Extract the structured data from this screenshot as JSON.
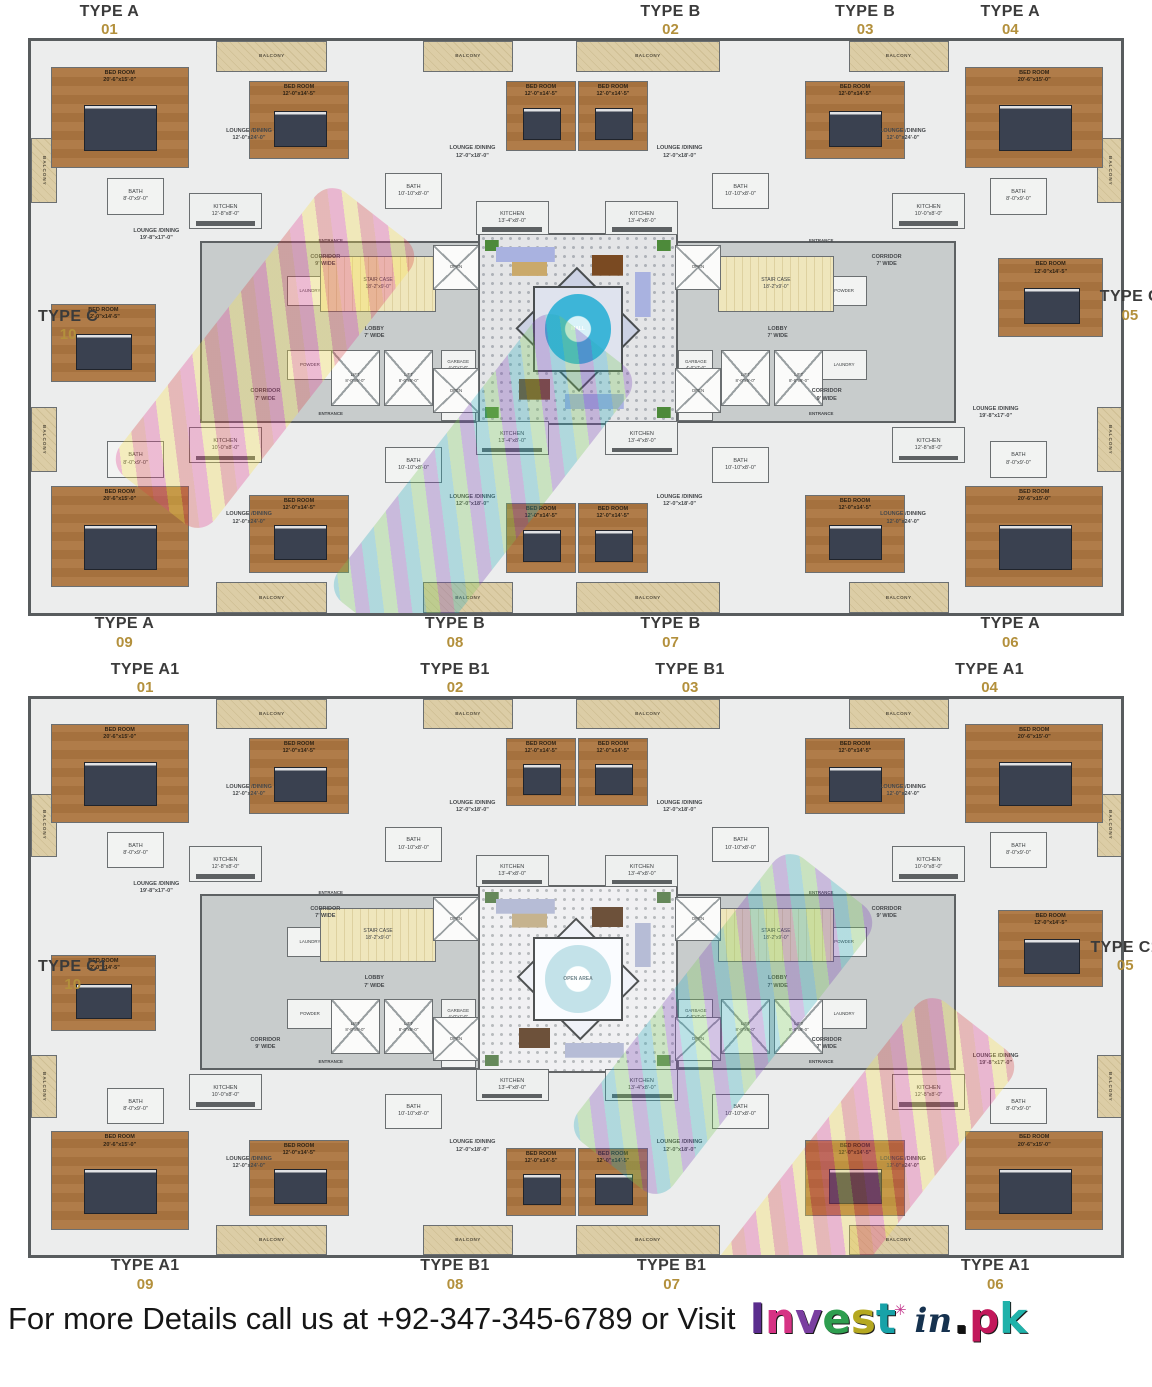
{
  "page": {
    "background": "#ffffff"
  },
  "colors": {
    "accent_gold": "#b3903c",
    "label_dark": "#3b3b3b",
    "wall": "#5d6163",
    "wood_floor": "#a5713e",
    "balcony_tan": "#d9c9a1",
    "stair_yellow": "#efe6bc",
    "fountain_cyan": "#3db5d8",
    "sofa_periwinkle": "#a9b2e0",
    "plant_green": "#4d8a3a"
  },
  "plans": [
    {
      "id": "upper-typical-floor",
      "center_label": "MALL",
      "units": [
        {
          "type": "TYPE A",
          "num": "01"
        },
        {
          "type": "TYPE B",
          "num": "02"
        },
        {
          "type": "TYPE B",
          "num": "03"
        },
        {
          "type": "TYPE A",
          "num": "04"
        },
        {
          "type": "TYPE C",
          "num": "05"
        },
        {
          "type": "TYPE A",
          "num": "06"
        },
        {
          "type": "TYPE B",
          "num": "07"
        },
        {
          "type": "TYPE B",
          "num": "08"
        },
        {
          "type": "TYPE A",
          "num": "09"
        },
        {
          "type": "TYPE C",
          "num": "10"
        }
      ]
    },
    {
      "id": "lower-typical-floor",
      "center_label": "OPEN AREA",
      "units": [
        {
          "type": "TYPE A1",
          "num": "01"
        },
        {
          "type": "TYPE B1",
          "num": "02"
        },
        {
          "type": "TYPE B1",
          "num": "03"
        },
        {
          "type": "TYPE A1",
          "num": "04"
        },
        {
          "type": "TYPE C1",
          "num": "05"
        },
        {
          "type": "TYPE A1",
          "num": "06"
        },
        {
          "type": "TYPE B1",
          "num": "07"
        },
        {
          "type": "TYPE B1",
          "num": "08"
        },
        {
          "type": "TYPE A1",
          "num": "09"
        },
        {
          "type": "TYPE C1",
          "num": "10"
        }
      ]
    }
  ],
  "labels": {
    "balcony": "BALCONY",
    "bedroom": "BED ROOM\n20'-6\"x15'-0\"",
    "bedroom2": "BED ROOM\n12'-0\"x14'-5\"",
    "lounge_a": "LOUNGE /DINING\n12'-0\"x24'-0\"",
    "lounge_b": "LOUNGE /DINING\n12'-0\"x18'-0\"",
    "lounge_c": "LOUNGE /DINING\n19'-8\"x17'-0\"",
    "kitchen_a": "KITCHEN\n10'-0\"x8'-0\"",
    "kitchen_b": "KITCHEN\n13'-4\"x8'-0\"",
    "kitchen_c": "KITCHEN\n12'-8\"x8'-0\"",
    "bath": "BATH\n8'-0\"x9'-0\"",
    "bath2": "BATH\n10'-10\"x8'-0\"",
    "laundry": "LAUNDRY",
    "powder": "POWDER",
    "entrance": "ENTRANCE",
    "corridor9": "CORRIDOR\n9' WIDE",
    "corridor7": "CORRIDOR\n7' WIDE",
    "lobby": "LOBBY\n7' WIDE",
    "staircase": "STAIR CASE\n18'-2\"x9'-0\"",
    "lift": "LIFT\n8'-0\"x6'-0\"",
    "garbage": "GARBAGE\n4'-0\"x7'-0\"",
    "electrical": "ELECTRICAL\n7'-6\"x4'-0\"",
    "open": "OPEN"
  },
  "footer": {
    "message": "For more Details call us at +92-347-345-6789 or Visit",
    "logo": {
      "invest_letters": [
        "I",
        "n",
        "v",
        "e",
        "s",
        "t"
      ],
      "mid": "in",
      "dot": ".",
      "pk_letters": [
        "p",
        "k"
      ],
      "spark": "✳"
    }
  }
}
